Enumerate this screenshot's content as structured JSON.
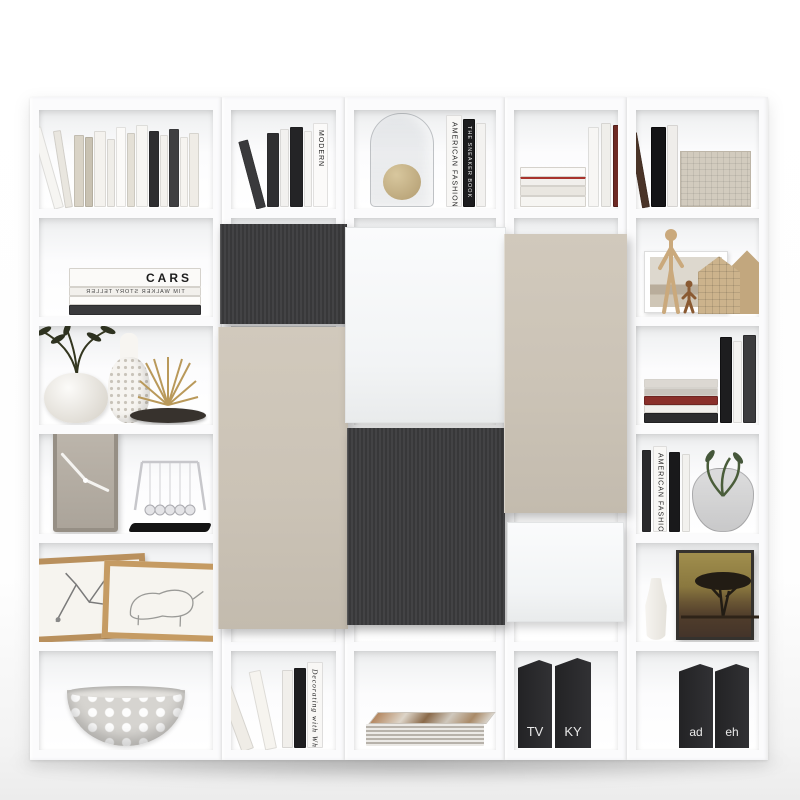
{
  "scene": {
    "title": "White modular cube shelving unit (5 columns x 6 rows) with charcoal, taupe and white door panels, styled with books and decor",
    "background_color": "#ffffff"
  },
  "unit": {
    "columns": 5,
    "rows": 6,
    "frame_color": "#fbfbfc",
    "panel_colors": {
      "dark": "#3b3b3d",
      "taupe": "#cbc3b6",
      "white": "#f7f8f9"
    }
  },
  "texts": {
    "cars": "CARS",
    "tim_walker": "TIM WALKER STORY TELLER",
    "modern": "MODERN",
    "american_fashion": "AMERICAN FASHION",
    "sneaker_book": "THE SNEAKER BOOK",
    "decorating_with_white": "Decorating with White",
    "binder_tv": "TV",
    "binder_ky": "KY",
    "binder_ad": "ad",
    "binder_eh": "eh"
  },
  "decor": {
    "column1": [
      "leaning row of white and dark books",
      "stack of books with CARS on top spine",
      "round vase with olive branches, bottle vase, gold air plants, dark bowl",
      "square taupe wall clock and newton's cradle",
      "two wooden picture frames with sketches",
      "white perforated decorative bowl"
    ],
    "column2": [
      "books incl. MODERN spine",
      "charcoal door panel",
      "tall taupe door panel",
      "leaning books incl. Decorating with White spine"
    ],
    "column3": [
      "glass cloche with dried ball and AMERICAN FASHION books",
      "large white door panel",
      "charcoal door panel",
      "stack of magazines"
    ],
    "column4": [
      "horizontal book stack and upright books",
      "tall taupe door panel",
      "small white door panel",
      "black binders TV and KY"
    ],
    "column5": [
      "dark books and woven box",
      "wooden mannequin, photo frame and model houses",
      "book stack and dark upright books",
      "AMERICAN FASHION books and glass vase with plant",
      "white vase and framed acacia tree picture",
      "black binders ad and eh"
    ]
  }
}
